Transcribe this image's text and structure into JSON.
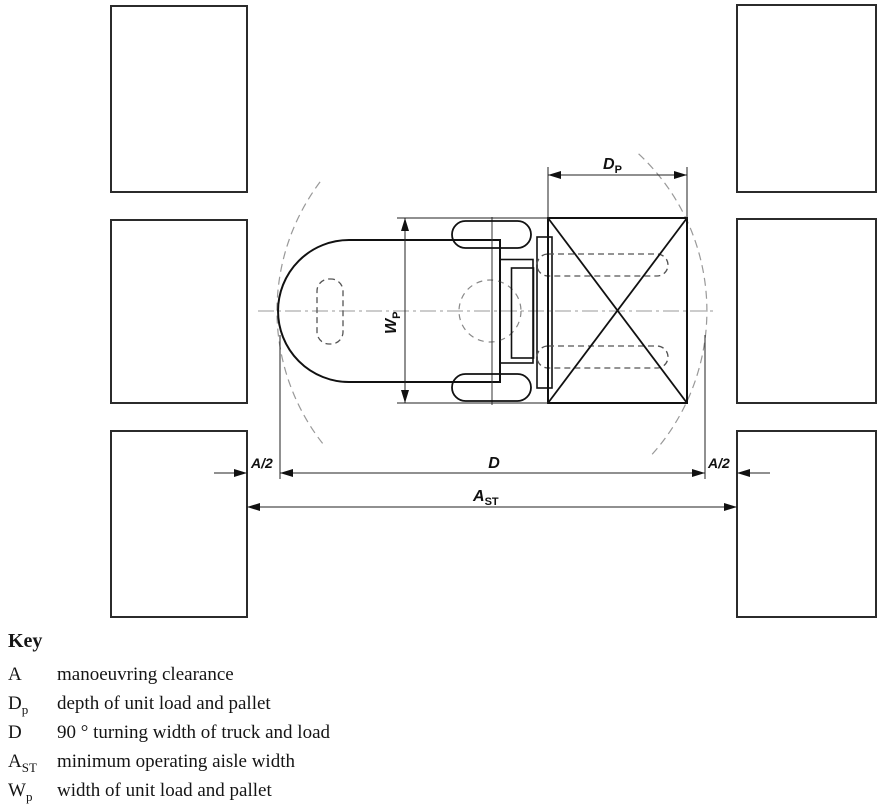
{
  "figure": {
    "type": "technical-drawing",
    "subject": "counterbalance truck with unit load turning 90 degrees in an aisle between racking blocks"
  },
  "labels": {
    "dp_main": "D",
    "dp_sub": "P",
    "wp_main": "W",
    "wp_sub": "P",
    "a2_left": "A/2",
    "a2_right": "A/2",
    "d": "D",
    "ast_main": "A",
    "ast_sub": "ST"
  },
  "key": {
    "title": "Key",
    "entries": [
      {
        "sym": "A",
        "sub": "",
        "desc": "manoeuvring clearance"
      },
      {
        "sym": "D",
        "sub": "p",
        "desc": "depth of unit load and pallet"
      },
      {
        "sym": "D",
        "sub": "",
        "desc": "90 ° turning width of truck and load"
      },
      {
        "sym": "A",
        "sub": "ST",
        "desc": "minimum operating aisle width"
      },
      {
        "sym": "W",
        "sub": "p",
        "desc": "width of unit load and pallet"
      }
    ]
  },
  "colors": {
    "line": "#1a1a1a",
    "hidden_line": "#555555",
    "centerline": "#999999",
    "turning_arc": "#999999",
    "background": "#ffffff"
  }
}
